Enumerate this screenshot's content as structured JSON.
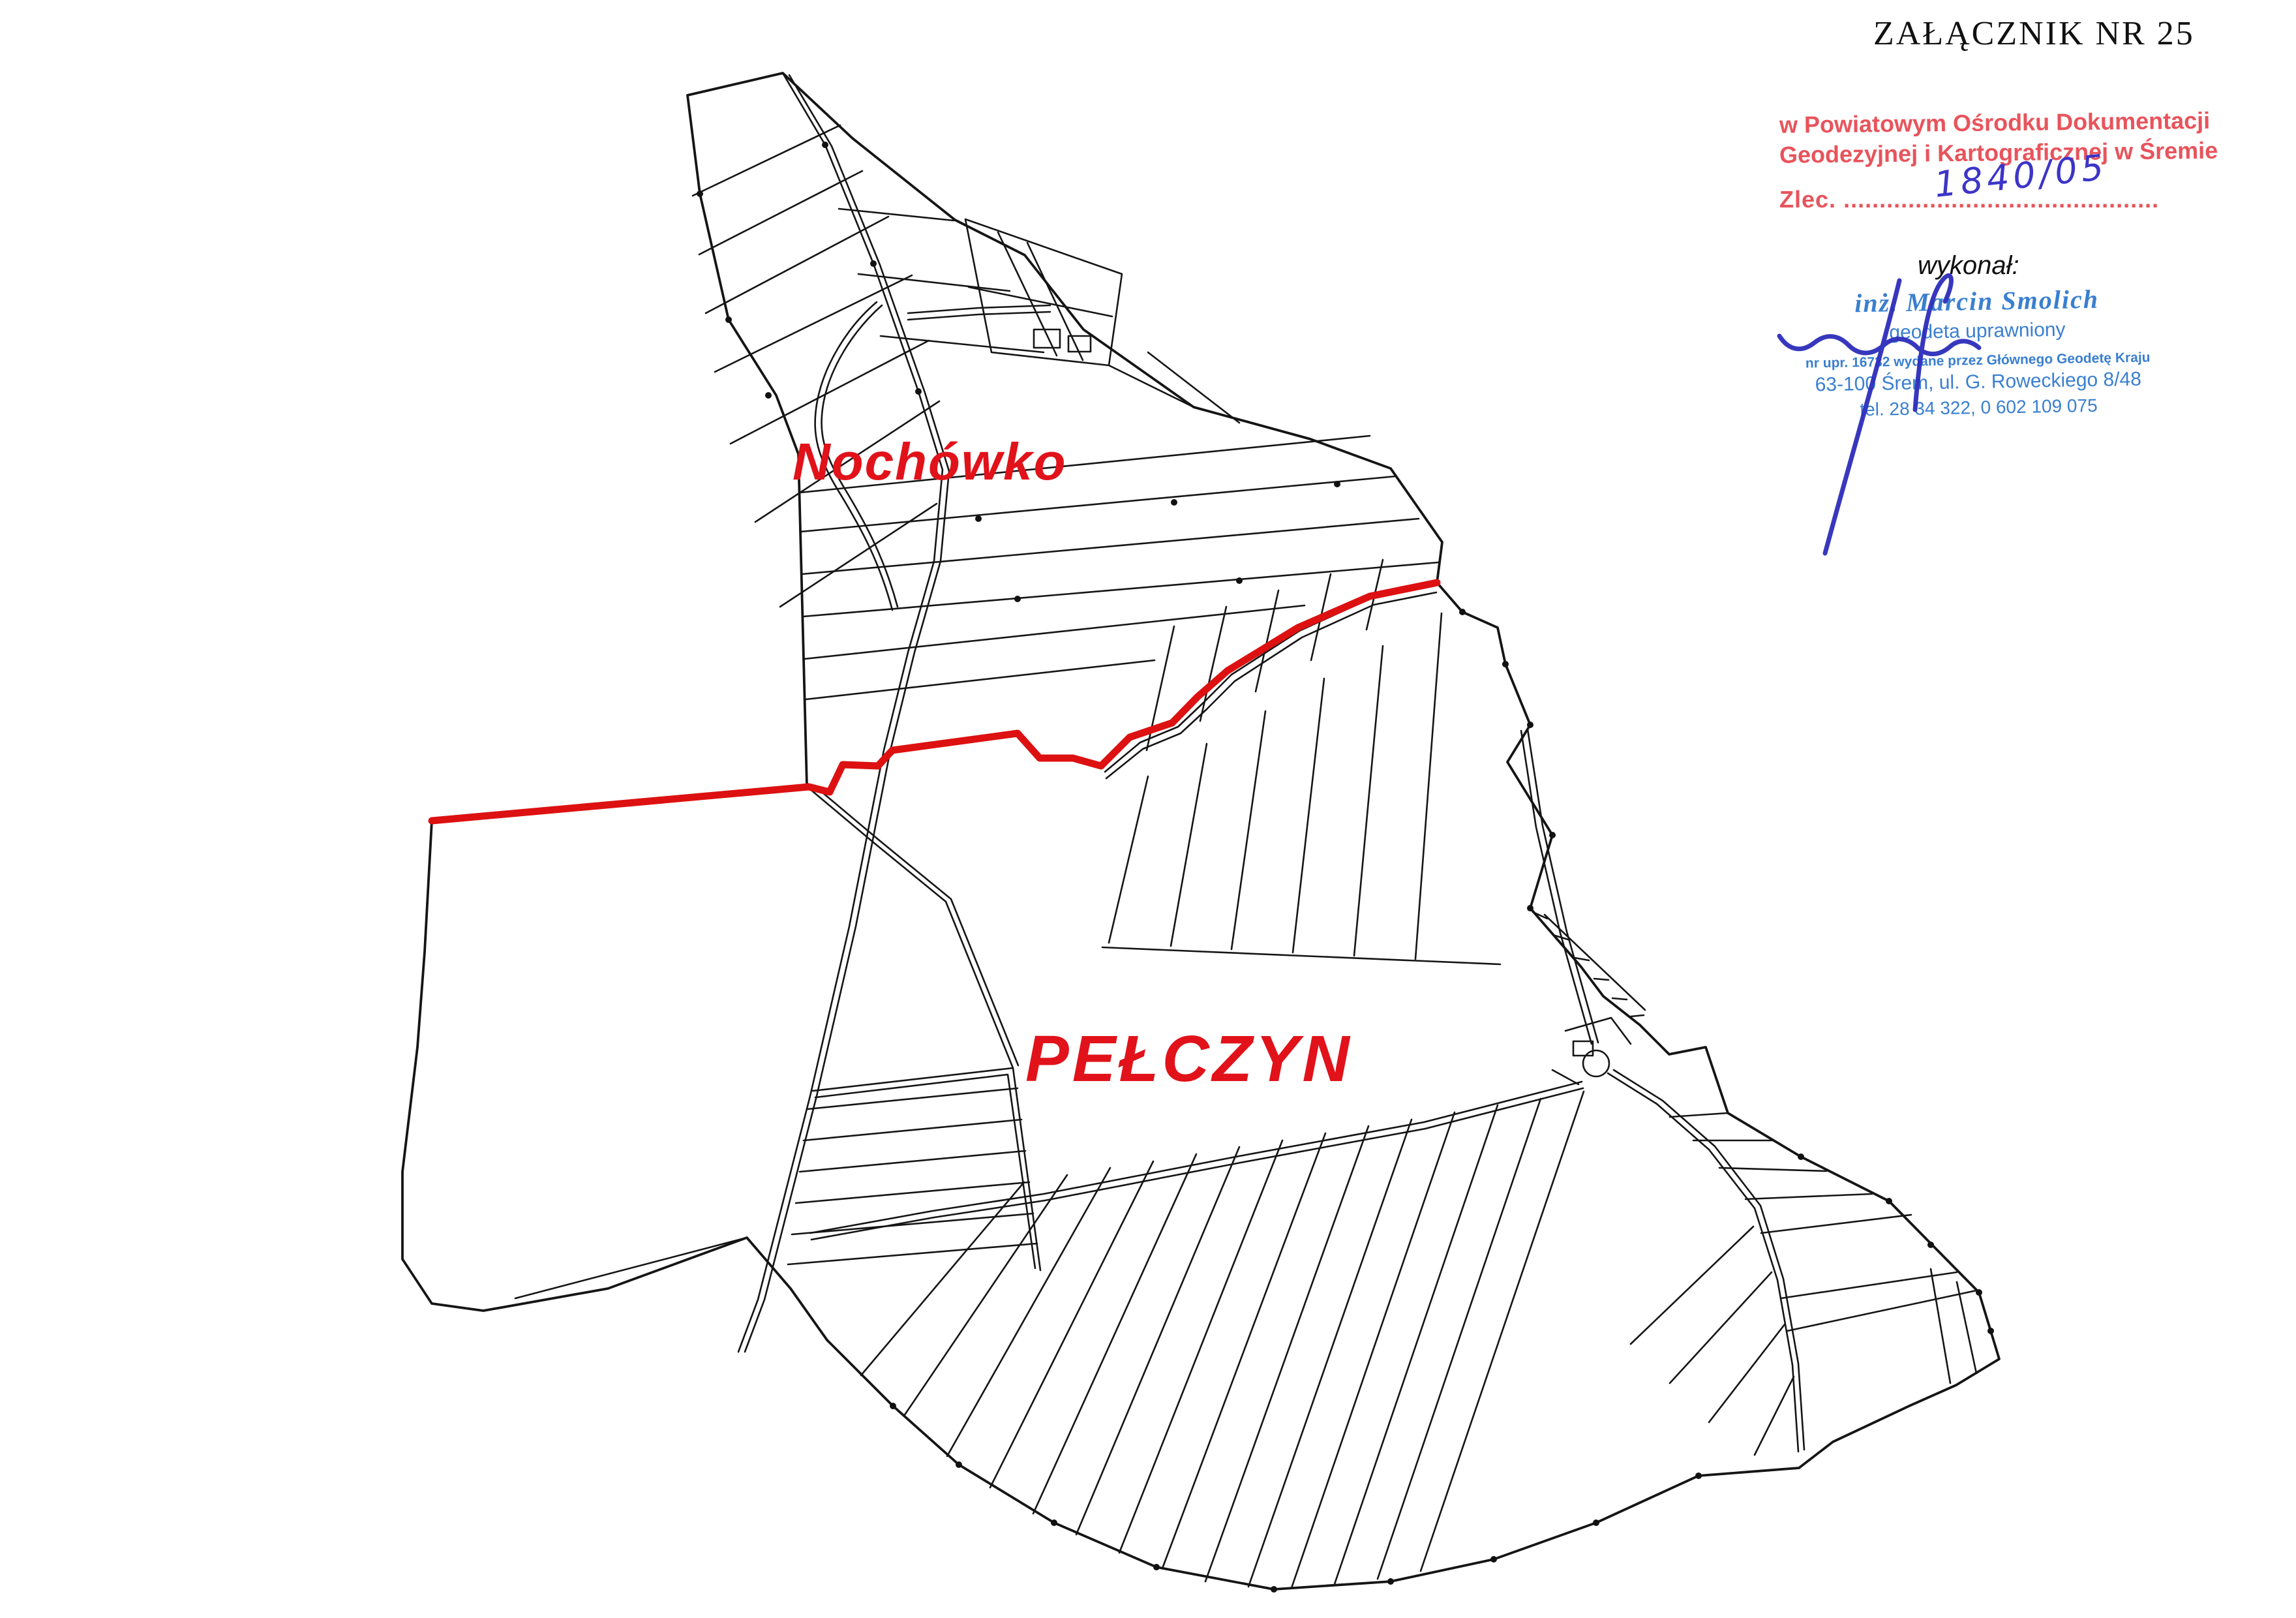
{
  "annex_title": "ZAŁĄCZNIK NR 25",
  "registry_stamp": {
    "line1": "w Powiatowym Ośrodku Dokumentacji",
    "line2": "Geodezyjnej i Kartograficznej w Śremie",
    "zlec_label": "Zlec.",
    "zlec_dots": "............................................",
    "zlec_number": "1840/05",
    "color": "#e8545c"
  },
  "wykonal_label": "wykonał:",
  "surveyor_stamp": {
    "name": "inż. Marcin Smolich",
    "title": "geodeta uprawniony",
    "license": "nr upr. 16732 wydane przez Głównego Geodetę Kraju",
    "address": "63-100 Śrem, ul. G. Roweckiego 8/48",
    "phone": "tel. 28 34 322,  0 602 109 075",
    "color": "#3a7fd0",
    "ink_color": "#2d2dbb"
  },
  "map": {
    "label_nochowko": "Nochówko",
    "label_pelczyn": "PEŁCZYN",
    "boundary_red": "#dd1111",
    "label_red": "#e1121a",
    "line_color": "#151515"
  }
}
